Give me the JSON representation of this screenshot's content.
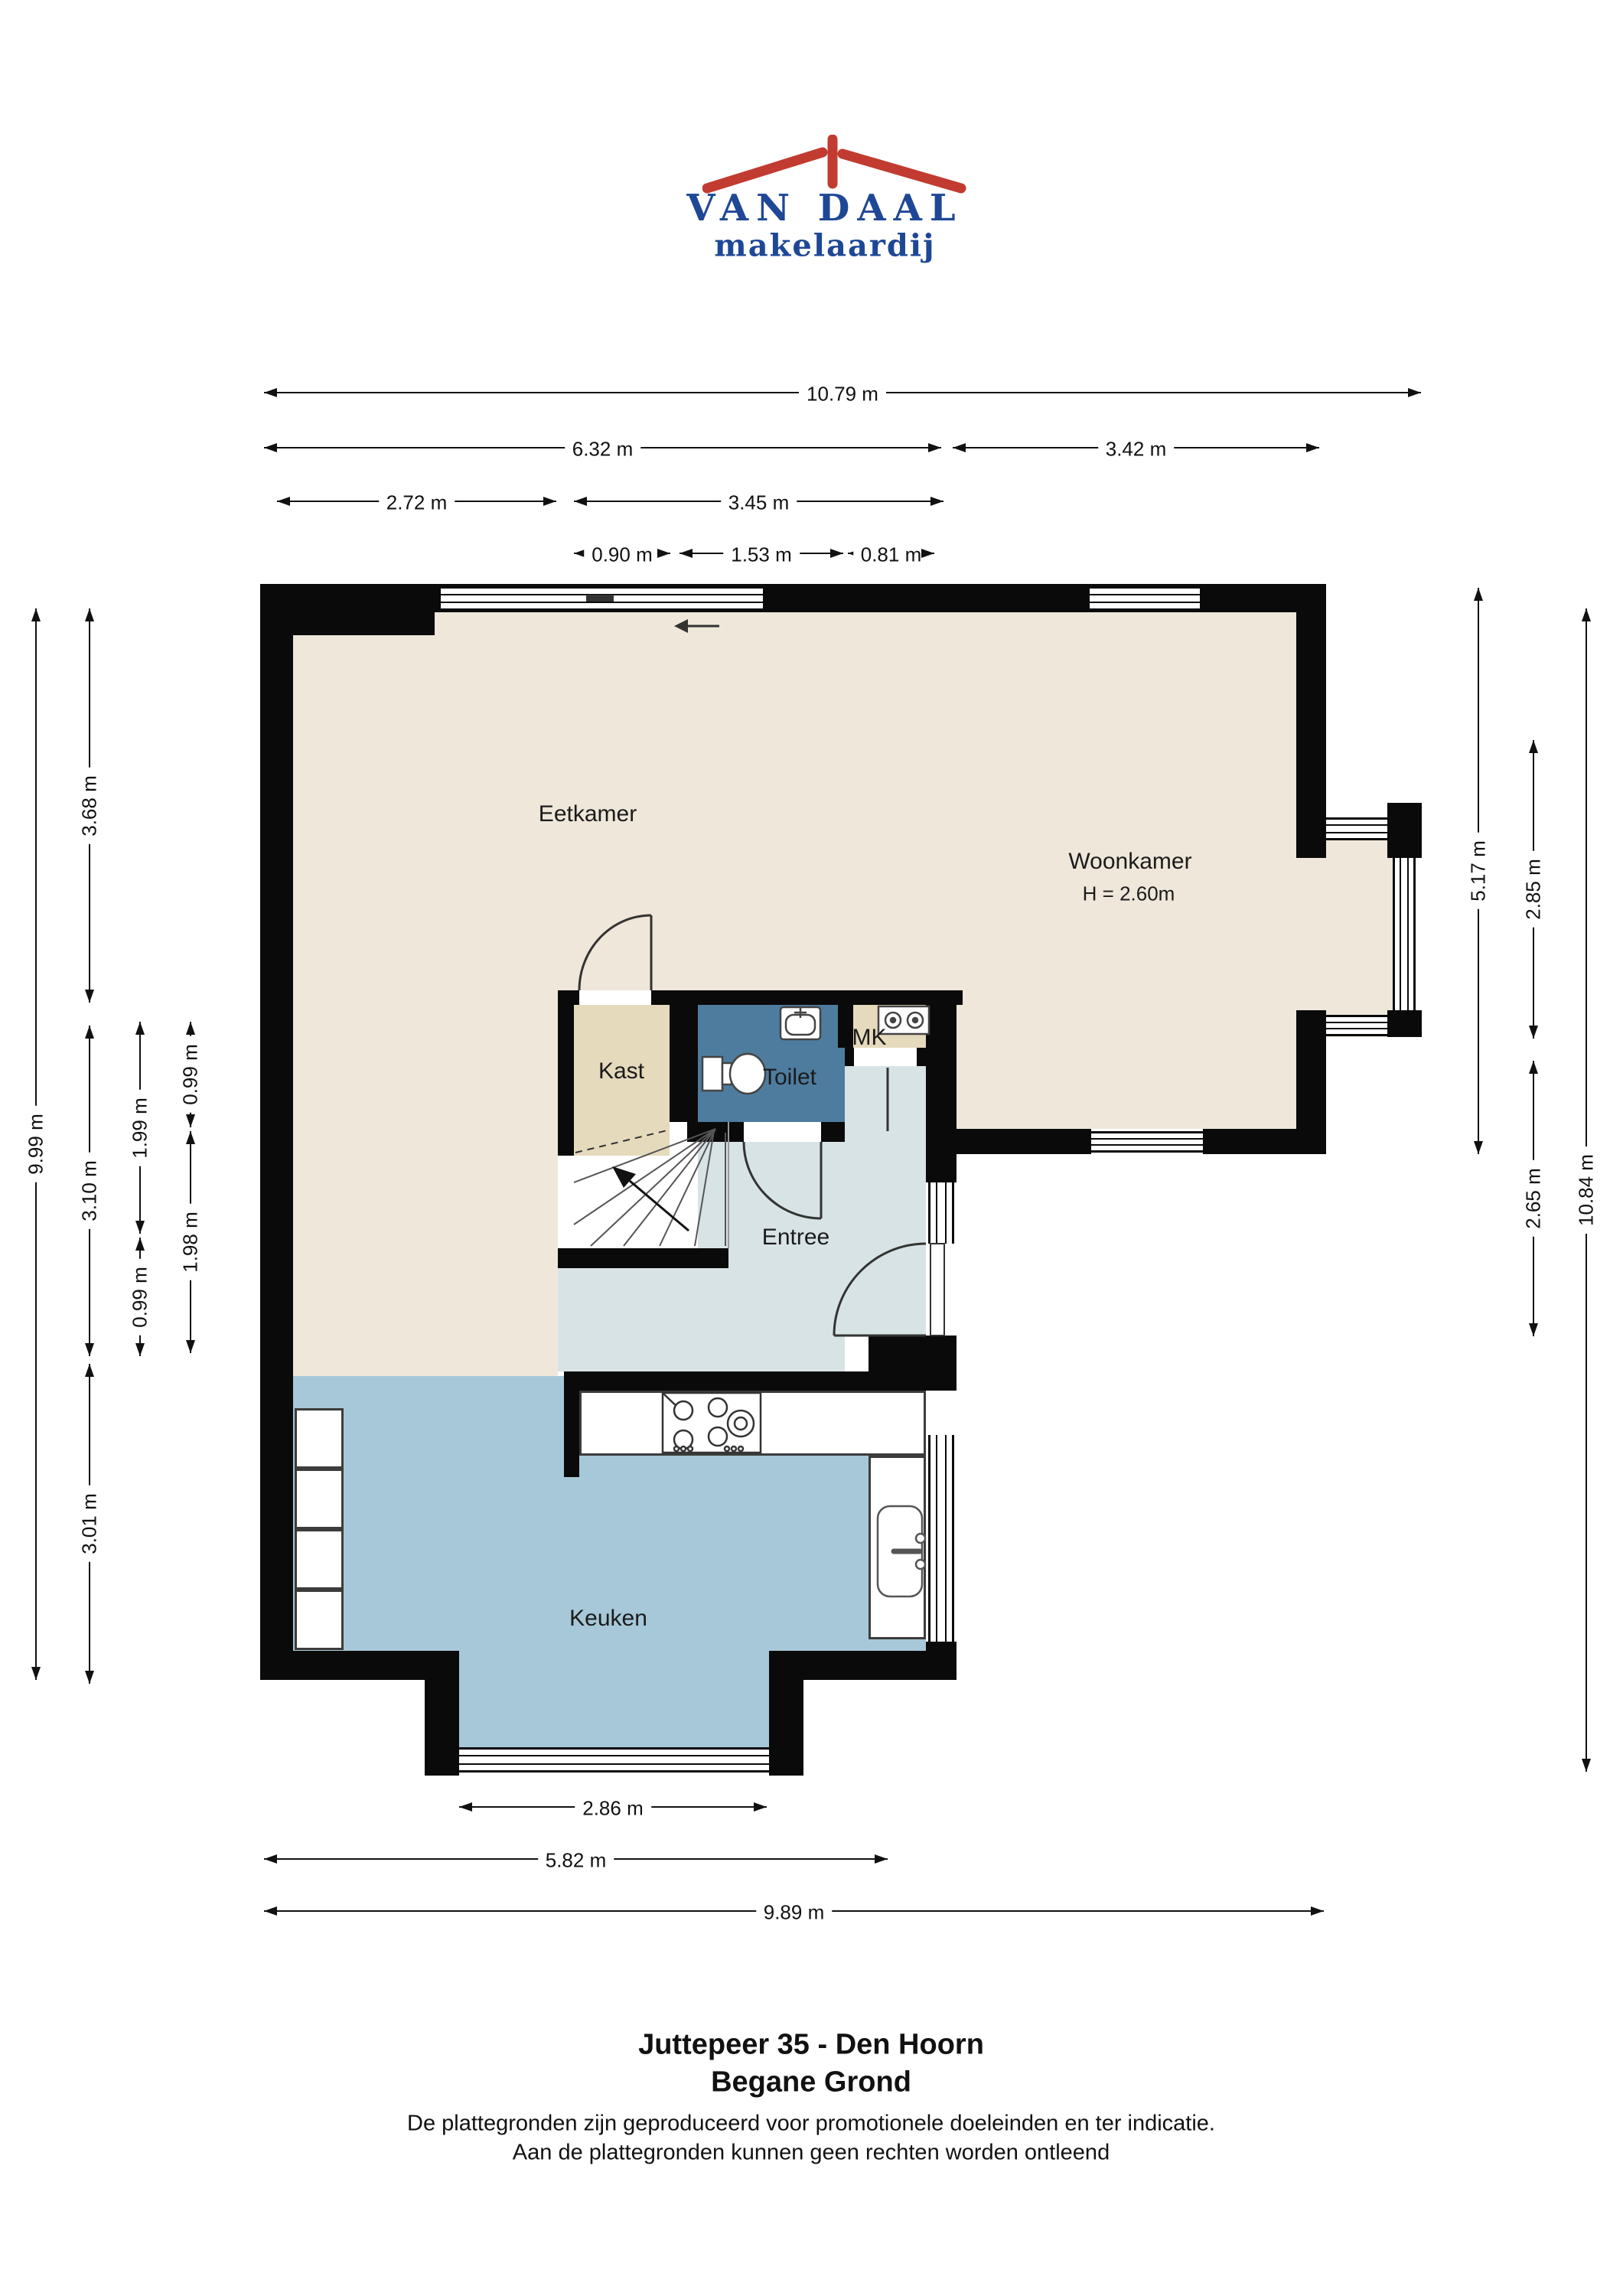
{
  "logo": {
    "name": "VAN DAAL",
    "tagline": "makelaardij"
  },
  "title": {
    "line1": "Juttepeer 35 - Den Hoorn",
    "line2": "Begane Grond"
  },
  "disclaimer": {
    "line1": "De plattegronden zijn geproduceerd voor promotionele doeleinden en ter indicatie.",
    "line2": "Aan de plattegronden kunnen geen rechten worden ontleend"
  },
  "rooms": {
    "eetkamer": "Eetkamer",
    "woonkamer": "Woonkamer",
    "woonkamer_height": "H = 2.60m",
    "kast": "Kast",
    "toilet": "Toilet",
    "mk": "MK",
    "entree": "Entree",
    "keuken": "Keuken"
  },
  "dims": {
    "top_total": "10.79 m",
    "top_left": "6.32 m",
    "top_right": "3.42 m",
    "eetkamer_width": "2.72 m",
    "middle_width": "3.45 m",
    "kast_width": "0.90 m",
    "toilet_width": "1.53 m",
    "mk_width": "0.81 m",
    "left_total": "9.99 m",
    "left_top": "3.68 m",
    "left_mid": "3.10 m",
    "left_bottom": "3.01 m",
    "inner_left_top": "1.99 m",
    "inner_left_bottom": "0.99 m",
    "inner_right_top": "0.99 m",
    "inner_right_bottom": "1.98 m",
    "right_top": "5.17 m",
    "right_upper": "2.85 m",
    "right_lower": "2.65 m",
    "right_total": "10.84 m",
    "bottom_bay": "2.86 m",
    "bottom_mid": "5.82 m",
    "bottom_total": "9.89 m"
  },
  "colors": {
    "wall": "#0a0a0a",
    "floor_living": "#EEE7DA",
    "floor_closet": "#E6DABD",
    "floor_toilet": "#4E7C9E",
    "floor_entry": "#D8E3E6",
    "floor_kitchen": "#A7C8D8",
    "logo_red": "#C23B30",
    "logo_blue": "#1E4796",
    "dim_line": "#111111"
  }
}
